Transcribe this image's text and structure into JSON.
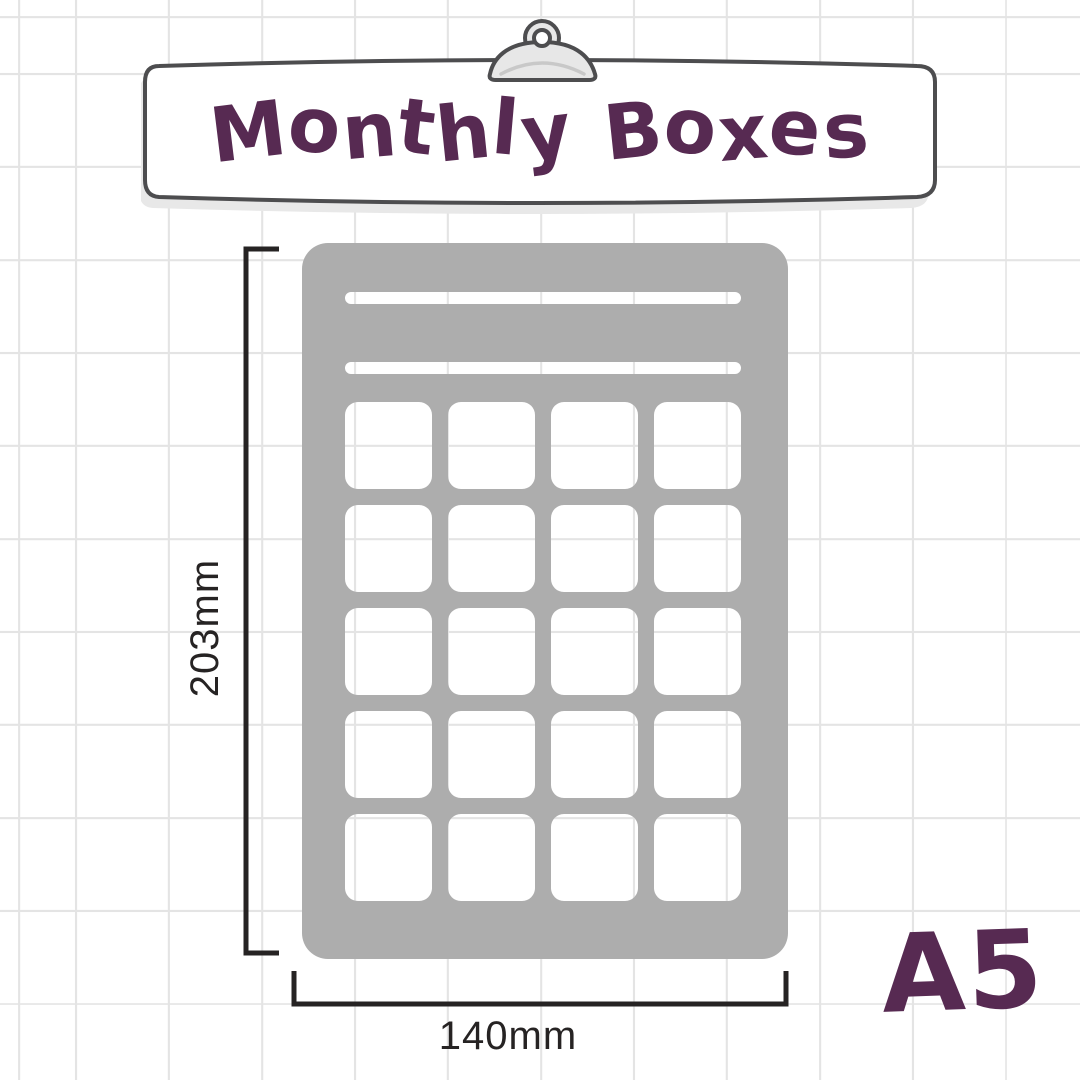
{
  "header": {
    "title": "Monthly Boxes"
  },
  "icons": {
    "clip": "clipboard-clip-icon"
  },
  "stencil": {
    "description": "A5 monthly boxes stencil silhouette",
    "header_slots": 2,
    "box_rows": 5,
    "box_cols": 4
  },
  "dimensions": {
    "height": "203mm",
    "width": "140mm"
  },
  "paper_size": "A5",
  "colors": {
    "background": "#ffffff",
    "grid_line": "#e4e4e4",
    "accent_purple": "#572a52",
    "stencil_gray": "#adadad",
    "banner_fill": "#ffffff",
    "banner_outline": "#4d4d4f",
    "banner_shadow": "#e8e8e8",
    "clip_fill": "#e7e7e7",
    "clip_inner_arc": "#c8c8c8",
    "dimension_line": "#262323"
  }
}
